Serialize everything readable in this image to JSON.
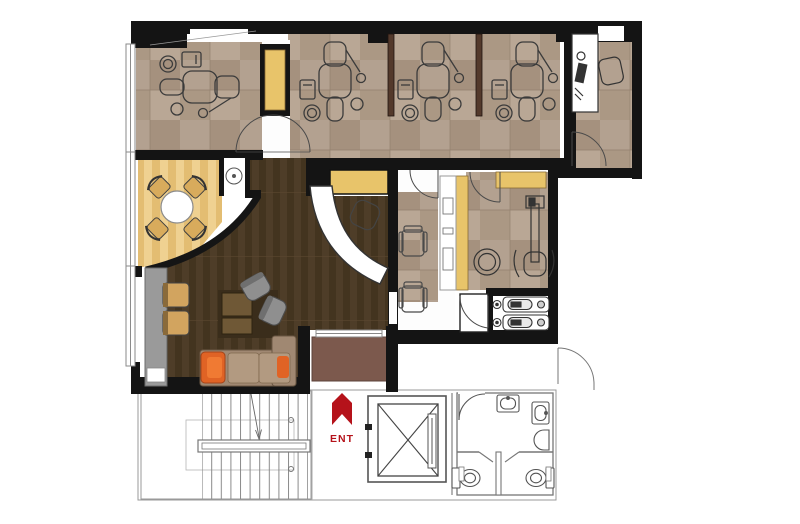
{
  "floor_plan": {
    "entrance": {
      "label": "ENT",
      "arrow_icon": "up-arrow-bookmark",
      "color": "#b5121a"
    },
    "colors": {
      "wall": "#141414",
      "tile_beige": "#b3a190",
      "tile_beige_alt": "#a5917e",
      "wood_light": "#ecca82",
      "wood_dark": "#4b3b26",
      "mat_brown": "#7c594d",
      "cabinet_yellow": "#e8c46a",
      "sofa_taupe": "#a08872",
      "cushion_orange": "#e06325",
      "chair_gray": "#8f8f8f",
      "outline_gray": "#888888",
      "accent_red": "#b5121a"
    }
  }
}
